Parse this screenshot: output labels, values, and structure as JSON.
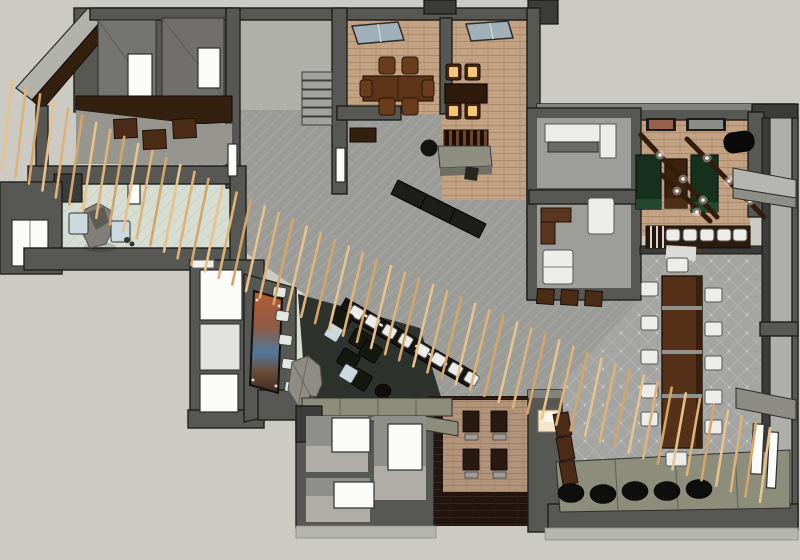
{
  "meta": {
    "description": "overhead-3d-floorplan-render-restaurant-lounge",
    "text_visible": false
  },
  "palette": {
    "bg": "#cbcbc3",
    "wallMid": "#575753",
    "wallDark": "#3b3b39",
    "wallLight": "#b2b2ac",
    "tile": "#9b9b97",
    "diamond": "#a4a4a2",
    "brick": "#c3a284",
    "rug": "#b2947a",
    "mint": "#d6ddd2",
    "wood": "#241711",
    "woodBar": "#33200f",
    "woodTable": "#55311a",
    "chairBrown": "#6b3d1f",
    "greenTable": "#16321f",
    "seatBlue": "#ccd8e0",
    "glow": "#f3c775",
    "olive": "#8d8d7b",
    "stone": "#827e78",
    "slat": "#e8c18c"
  },
  "scene": {
    "rooms": [
      {
        "name": "private-dining-room-1",
        "seats": 6,
        "floor": "tan-carpet",
        "skylight": true
      },
      {
        "name": "private-dining-room-2",
        "seats": 4,
        "lit_cushions": true,
        "skylight": true
      },
      {
        "name": "games-room",
        "green-tables": 2,
        "wood-table": 1,
        "pendant-beams": 3,
        "bar-stools": 5
      },
      {
        "name": "lounge",
        "black-chairs": 5,
        "blue-tables": 2,
        "mural": true,
        "rock-garden": true
      },
      {
        "name": "entry-vestibule",
        "rock-feature": true,
        "blue-seats": 2
      },
      {
        "name": "communal-dining",
        "table-chairs": 12
      },
      {
        "name": "diagonal-bar",
        "stools": 8
      },
      {
        "name": "restrooms",
        "doors": 3
      },
      {
        "name": "staff-rooms",
        "count": 2
      },
      {
        "name": "terrace-edge",
        "pouf-row": 5
      }
    ],
    "feature": "diagonal-timber-slat-screen"
  },
  "slat_screen": {
    "count": 55,
    "x0": 12,
    "y0": 80,
    "x1": 770,
    "y1": 428,
    "bow": 12,
    "len0": 90,
    "len1": 74,
    "lean_min": 10,
    "lean_amp": 10,
    "width": 2.6,
    "colors": [
      "#e8c18c",
      "#dfb277",
      "#d4a569"
    ]
  },
  "generated": [
    {
      "id": "stair-treads",
      "shape": "rect",
      "w": 30,
      "h": 8,
      "cls": "tread",
      "items": [
        [
          302,
          72
        ],
        [
          302,
          81
        ],
        [
          302,
          90
        ],
        [
          302,
          99
        ],
        [
          302,
          108
        ],
        [
          302,
          117
        ]
      ]
    },
    {
      "id": "cube-chairs-a",
      "shape": "rect",
      "w": 23,
      "h": 19,
      "rot": -3,
      "cls": "cube-brown",
      "items": [
        [
          114,
          119
        ],
        [
          143,
          130
        ],
        [
          173,
          119
        ]
      ]
    },
    {
      "id": "dining1-chairs",
      "shape": "rect",
      "w": 16,
      "h": 17,
      "rx": 3,
      "cls": "chair-brown",
      "items": [
        [
          379,
          57
        ],
        [
          402,
          57
        ],
        [
          379,
          98
        ],
        [
          402,
          98
        ]
      ]
    },
    {
      "id": "dining1-side-chairs",
      "shape": "rect",
      "w": 12,
      "h": 17,
      "rx": 3,
      "cls": "chair-brown",
      "items": [
        [
          360,
          80
        ],
        [
          422,
          80
        ]
      ]
    },
    {
      "id": "dining2-chair-frames",
      "shape": "rect",
      "w": 15,
      "h": 16,
      "rx": 2,
      "cls": "chair-glow-frame",
      "items": [
        [
          446,
          64
        ],
        [
          465,
          64
        ],
        [
          446,
          103
        ],
        [
          465,
          103
        ]
      ]
    },
    {
      "id": "dining2-chair-glow",
      "shape": "rect",
      "w": 9,
      "h": 10,
      "rx": 1,
      "cls": "glow",
      "items": [
        [
          449,
          67
        ],
        [
          468,
          67
        ],
        [
          449,
          106
        ],
        [
          468,
          106
        ]
      ]
    },
    {
      "id": "bar2-stools",
      "shape": "rect",
      "w": 14,
      "h": 12,
      "rx": 3,
      "cls": "chair-white",
      "items": [
        [
          666,
          229
        ],
        [
          683,
          229
        ],
        [
          700,
          229
        ],
        [
          717,
          229
        ],
        [
          733,
          229
        ]
      ]
    },
    {
      "id": "beam-light-glow",
      "shape": "circle",
      "r": 4.5,
      "cls": "light-glow",
      "items": [
        [
          660,
          155
        ],
        [
          683,
          179
        ],
        [
          703,
          200
        ],
        [
          707,
          158
        ],
        [
          729,
          181
        ],
        [
          750,
          201
        ],
        [
          677,
          191
        ],
        [
          697,
          212
        ]
      ]
    },
    {
      "id": "beam-light-core",
      "shape": "circle",
      "r": 1.8,
      "cls": "light-core",
      "items": [
        [
          660,
          155
        ],
        [
          683,
          179
        ],
        [
          703,
          200
        ],
        [
          707,
          158
        ],
        [
          729,
          181
        ],
        [
          750,
          201
        ],
        [
          677,
          191
        ],
        [
          697,
          212
        ]
      ]
    },
    {
      "id": "cube-chairs-b",
      "shape": "rect",
      "w": 17,
      "h": 15,
      "rot": 4,
      "cls": "cube-brown",
      "items": [
        [
          537,
          289
        ],
        [
          561,
          290
        ],
        [
          585,
          291
        ]
      ]
    },
    {
      "id": "communal-chairs-left",
      "shape": "rect",
      "w": 17,
      "h": 14,
      "rx": 2,
      "cls": "chair-white",
      "items": [
        [
          641,
          282
        ],
        [
          641,
          316
        ],
        [
          641,
          350
        ],
        [
          641,
          384
        ],
        [
          641,
          412
        ]
      ]
    },
    {
      "id": "communal-chairs-right",
      "shape": "rect",
      "w": 17,
      "h": 14,
      "rx": 2,
      "cls": "chair-white",
      "items": [
        [
          705,
          288
        ],
        [
          705,
          322
        ],
        [
          705,
          356
        ],
        [
          705,
          390
        ],
        [
          705,
          420
        ]
      ]
    },
    {
      "id": "communal-end-chairs",
      "shape": "rect",
      "w": 21,
      "h": 14,
      "rx": 2,
      "cls": "chair-white",
      "items": [
        [
          667,
          258
        ],
        [
          666,
          452
        ]
      ]
    },
    {
      "id": "communal-table-bands",
      "shape": "rect",
      "w": 40,
      "h": 4,
      "cls": "band-gray",
      "items": [
        [
          662,
          306
        ],
        [
          662,
          350
        ],
        [
          662,
          394
        ]
      ]
    },
    {
      "id": "bar1-stools",
      "shape": "rect",
      "w": 13,
      "h": 11,
      "rx": 2,
      "rot": 31,
      "cls": "chair-white",
      "items": [
        [
          350,
          307
        ],
        [
          366,
          316
        ],
        [
          383,
          326
        ],
        [
          399,
          335
        ],
        [
          416,
          345
        ],
        [
          432,
          354
        ],
        [
          449,
          364
        ],
        [
          465,
          373
        ]
      ]
    },
    {
      "id": "lounge-chairs",
      "shape": "rect",
      "w": 19,
      "h": 17,
      "rx": 2,
      "rot": 31,
      "cls": "chair-dark",
      "items": [
        [
          332,
          310
        ],
        [
          351,
          331
        ],
        [
          339,
          351
        ],
        [
          361,
          343
        ],
        [
          351,
          371
        ]
      ]
    },
    {
      "id": "lounge-tables",
      "shape": "rect",
      "w": 15,
      "h": 15,
      "rx": 2,
      "rot": 31,
      "cls": "table-blue",
      "items": [
        [
          326,
          325
        ],
        [
          341,
          366
        ]
      ]
    },
    {
      "id": "bench-row",
      "shape": "rect",
      "w": 13,
      "h": 10,
      "rx": 2,
      "rot": 8,
      "cls": "seat-light",
      "items": [
        [
          273,
          287
        ],
        [
          276,
          311
        ],
        [
          279,
          335
        ],
        [
          282,
          359
        ],
        [
          285,
          382
        ]
      ]
    },
    {
      "id": "lounge-poufs",
      "shape": "ellipse",
      "rxe": 8,
      "rye": 7,
      "cls": "pouf",
      "items": [
        [
          383,
          391
        ],
        [
          393,
          406
        ]
      ]
    },
    {
      "id": "pouf-row",
      "shape": "ellipse",
      "rxe": 13,
      "rye": 9.5,
      "cls": "pouf",
      "items": [
        [
          571,
          493
        ],
        [
          603,
          494
        ],
        [
          635,
          491
        ],
        [
          667,
          491
        ],
        [
          699,
          489
        ]
      ]
    },
    {
      "id": "partition-chairs",
      "shape": "rect",
      "w": 15,
      "h": 23,
      "rot": -10,
      "cls": "cube-brown",
      "items": [
        [
          555,
          413
        ],
        [
          558,
          437
        ],
        [
          561,
          461
        ]
      ]
    },
    {
      "id": "rug-chairs",
      "shape": "rect",
      "w": 16,
      "h": 21,
      "cls": "chair-dark2",
      "items": [
        [
          463,
          411
        ],
        [
          491,
          411
        ],
        [
          463,
          449
        ],
        [
          491,
          449
        ]
      ]
    },
    {
      "id": "rug-stools",
      "shape": "rect",
      "w": 13,
      "h": 6,
      "cls": "stool-gray",
      "items": [
        [
          465,
          434
        ],
        [
          493,
          434
        ],
        [
          465,
          472
        ],
        [
          493,
          472
        ]
      ]
    },
    {
      "id": "entry-seats",
      "shape": "rect",
      "w": 19,
      "h": 21,
      "rx": 2,
      "cls": "table-blue",
      "items": [
        [
          69,
          213
        ],
        [
          111,
          221
        ]
      ]
    }
  ]
}
